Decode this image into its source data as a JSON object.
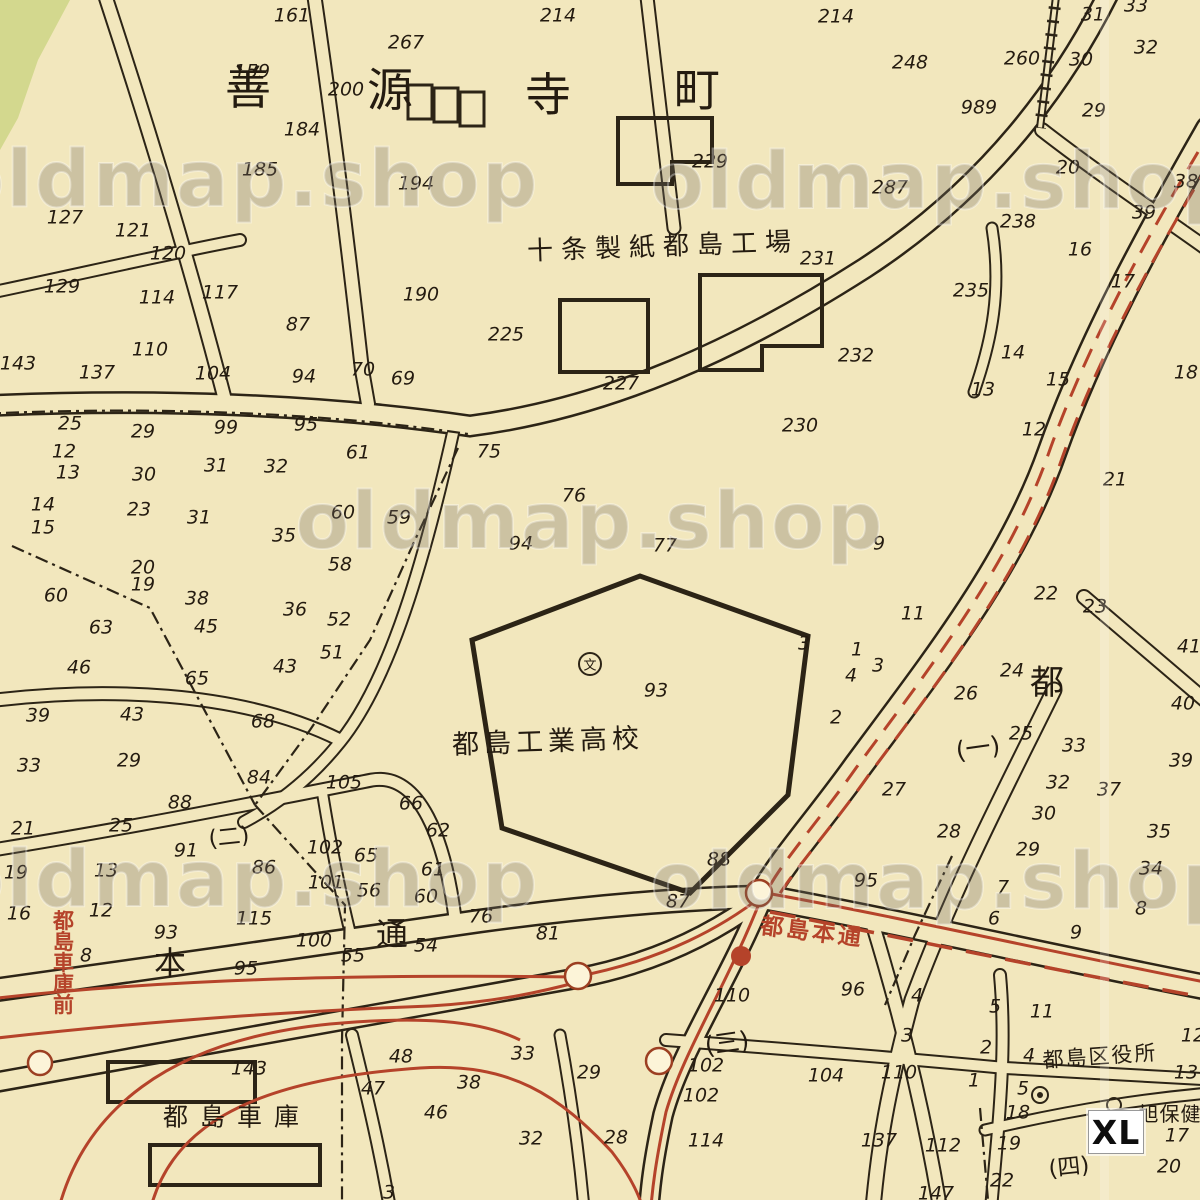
{
  "map": {
    "watermark_text": "oldmap.shop",
    "size_badge": "XL",
    "colors": {
      "paper": "#f2e7bd",
      "ink": "#2c2416",
      "tram_red": "#b5432a",
      "park_green": "#d3d88e"
    },
    "place_labels": [
      {
        "t": "善",
        "x": 248,
        "y": 88,
        "s": 46
      },
      {
        "t": "源",
        "x": 390,
        "y": 90,
        "s": 46
      },
      {
        "t": "寺",
        "x": 548,
        "y": 95,
        "s": 46
      },
      {
        "t": "町",
        "x": 697,
        "y": 90,
        "s": 46
      },
      {
        "t": "十条製紙都島工場",
        "x": 663,
        "y": 247,
        "s": 26,
        "ls": 8,
        "rot": -2
      },
      {
        "t": "都島工業高校",
        "x": 548,
        "y": 742,
        "s": 27,
        "ls": 5,
        "rot": -2
      },
      {
        "t": "文",
        "x": 590,
        "y": 666,
        "s": 13
      },
      {
        "t": "都",
        "x": 1047,
        "y": 683,
        "s": 34
      },
      {
        "t": "(一)",
        "x": 978,
        "y": 748,
        "s": 25,
        "rot": -8
      },
      {
        "t": "(二)",
        "x": 229,
        "y": 838,
        "s": 23,
        "rot": -6
      },
      {
        "t": "(三)",
        "x": 727,
        "y": 1043,
        "s": 25,
        "rot": -8
      },
      {
        "t": "(四)",
        "x": 1069,
        "y": 1168,
        "s": 23,
        "rot": -6
      },
      {
        "t": "都島区役所",
        "x": 1100,
        "y": 1057,
        "s": 21,
        "ls": 2,
        "rot": -4
      },
      {
        "t": "旭保健",
        "x": 1170,
        "y": 1114,
        "s": 20,
        "ls": 1
      },
      {
        "t": "都島車庫",
        "x": 237,
        "y": 1117,
        "s": 25,
        "ls": 12
      },
      {
        "t": "本",
        "x": 170,
        "y": 963,
        "s": 32
      },
      {
        "t": "通",
        "x": 392,
        "y": 934,
        "s": 32
      }
    ],
    "red_labels": [
      {
        "t": "都島本通",
        "x": 812,
        "y": 933,
        "s": 23,
        "ls": 3,
        "rot": 7
      },
      {
        "t": "都島車庫前",
        "x": 62,
        "y": 962,
        "s": 21,
        "vertical": true
      }
    ],
    "watermarks": [
      {
        "x": 245,
        "y": 180
      },
      {
        "x": 945,
        "y": 182
      },
      {
        "x": 590,
        "y": 522
      },
      {
        "x": 245,
        "y": 880
      },
      {
        "x": 945,
        "y": 882
      }
    ],
    "symbols": [
      {
        "name": "school-symbol",
        "x": 590,
        "y": 664
      },
      {
        "name": "ward-office-symbol",
        "x": 1040,
        "y": 1095
      },
      {
        "name": "health-center-symbol",
        "x": 1114,
        "y": 1105
      },
      {
        "name": "tram-stop",
        "x": 578,
        "y": 976
      },
      {
        "name": "tram-stop",
        "x": 759,
        "y": 893
      },
      {
        "name": "tram-stop",
        "x": 659,
        "y": 1061
      },
      {
        "name": "tram-stop",
        "x": 40,
        "y": 1063
      },
      {
        "name": "tram-stop-filled",
        "x": 741,
        "y": 956
      }
    ],
    "lot_numbers": [
      {
        "t": "161",
        "x": 292,
        "y": 16
      },
      {
        "t": "159",
        "x": 252,
        "y": 72
      },
      {
        "t": "184",
        "x": 302,
        "y": 130
      },
      {
        "t": "185",
        "x": 260,
        "y": 170
      },
      {
        "t": "127",
        "x": 65,
        "y": 218
      },
      {
        "t": "121",
        "x": 133,
        "y": 231
      },
      {
        "t": "120",
        "x": 168,
        "y": 254
      },
      {
        "t": "129",
        "x": 62,
        "y": 287
      },
      {
        "t": "114",
        "x": 157,
        "y": 298
      },
      {
        "t": "117",
        "x": 220,
        "y": 293
      },
      {
        "t": "87",
        "x": 298,
        "y": 325
      },
      {
        "t": "110",
        "x": 150,
        "y": 350
      },
      {
        "t": "143",
        "x": 18,
        "y": 364
      },
      {
        "t": "137",
        "x": 97,
        "y": 373
      },
      {
        "t": "104",
        "x": 213,
        "y": 374
      },
      {
        "t": "94",
        "x": 304,
        "y": 377
      },
      {
        "t": "70",
        "x": 363,
        "y": 370
      },
      {
        "t": "69",
        "x": 403,
        "y": 379
      },
      {
        "t": "214",
        "x": 558,
        "y": 16
      },
      {
        "t": "267",
        "x": 406,
        "y": 43
      },
      {
        "t": "200",
        "x": 346,
        "y": 90
      },
      {
        "t": "194",
        "x": 416,
        "y": 184
      },
      {
        "t": "229",
        "x": 710,
        "y": 162
      },
      {
        "t": "287",
        "x": 890,
        "y": 188
      },
      {
        "t": "231",
        "x": 818,
        "y": 259
      },
      {
        "t": "190",
        "x": 421,
        "y": 295
      },
      {
        "t": "225",
        "x": 506,
        "y": 335
      },
      {
        "t": "227",
        "x": 621,
        "y": 384
      },
      {
        "t": "232",
        "x": 856,
        "y": 356
      },
      {
        "t": "230",
        "x": 800,
        "y": 426
      },
      {
        "t": "214",
        "x": 836,
        "y": 17
      },
      {
        "t": "248",
        "x": 910,
        "y": 63
      },
      {
        "t": "260",
        "x": 1022,
        "y": 59
      },
      {
        "t": "31",
        "x": 1093,
        "y": 15
      },
      {
        "t": "30",
        "x": 1081,
        "y": 60
      },
      {
        "t": "32",
        "x": 1146,
        "y": 48
      },
      {
        "t": "33",
        "x": 1136,
        "y": 6
      },
      {
        "t": "989",
        "x": 979,
        "y": 108
      },
      {
        "t": "29",
        "x": 1094,
        "y": 111
      },
      {
        "t": "20",
        "x": 1068,
        "y": 168
      },
      {
        "t": "38",
        "x": 1186,
        "y": 182
      },
      {
        "t": "39",
        "x": 1144,
        "y": 213
      },
      {
        "t": "238",
        "x": 1018,
        "y": 222
      },
      {
        "t": "16",
        "x": 1080,
        "y": 250
      },
      {
        "t": "17",
        "x": 1123,
        "y": 282
      },
      {
        "t": "235",
        "x": 971,
        "y": 291
      },
      {
        "t": "14",
        "x": 1013,
        "y": 353
      },
      {
        "t": "15",
        "x": 1058,
        "y": 380
      },
      {
        "t": "13",
        "x": 983,
        "y": 390
      },
      {
        "t": "12",
        "x": 1034,
        "y": 430
      },
      {
        "t": "18",
        "x": 1186,
        "y": 373
      },
      {
        "t": "21",
        "x": 1115,
        "y": 480
      },
      {
        "t": "25",
        "x": 70,
        "y": 424
      },
      {
        "t": "29",
        "x": 143,
        "y": 432
      },
      {
        "t": "12",
        "x": 64,
        "y": 452
      },
      {
        "t": "13",
        "x": 68,
        "y": 473
      },
      {
        "t": "30",
        "x": 144,
        "y": 475
      },
      {
        "t": "23",
        "x": 139,
        "y": 510
      },
      {
        "t": "14",
        "x": 43,
        "y": 505
      },
      {
        "t": "15",
        "x": 43,
        "y": 528
      },
      {
        "t": "99",
        "x": 226,
        "y": 428
      },
      {
        "t": "95",
        "x": 306,
        "y": 425
      },
      {
        "t": "31",
        "x": 216,
        "y": 466
      },
      {
        "t": "32",
        "x": 276,
        "y": 467
      },
      {
        "t": "31",
        "x": 199,
        "y": 518
      },
      {
        "t": "35",
        "x": 284,
        "y": 536
      },
      {
        "t": "20",
        "x": 143,
        "y": 568
      },
      {
        "t": "19",
        "x": 143,
        "y": 585
      },
      {
        "t": "60",
        "x": 56,
        "y": 596
      },
      {
        "t": "38",
        "x": 197,
        "y": 599
      },
      {
        "t": "36",
        "x": 295,
        "y": 610
      },
      {
        "t": "63",
        "x": 101,
        "y": 628
      },
      {
        "t": "45",
        "x": 206,
        "y": 627
      },
      {
        "t": "43",
        "x": 285,
        "y": 667
      },
      {
        "t": "65",
        "x": 197,
        "y": 679
      },
      {
        "t": "46",
        "x": 79,
        "y": 668
      },
      {
        "t": "39",
        "x": 38,
        "y": 716
      },
      {
        "t": "43",
        "x": 132,
        "y": 715
      },
      {
        "t": "61",
        "x": 358,
        "y": 453
      },
      {
        "t": "75",
        "x": 489,
        "y": 452
      },
      {
        "t": "60",
        "x": 343,
        "y": 513
      },
      {
        "t": "59",
        "x": 399,
        "y": 518
      },
      {
        "t": "58",
        "x": 340,
        "y": 565
      },
      {
        "t": "52",
        "x": 339,
        "y": 620
      },
      {
        "t": "51",
        "x": 332,
        "y": 653
      },
      {
        "t": "94",
        "x": 521,
        "y": 544
      },
      {
        "t": "76",
        "x": 574,
        "y": 496
      },
      {
        "t": "77",
        "x": 665,
        "y": 546
      },
      {
        "t": "9",
        "x": 879,
        "y": 544
      },
      {
        "t": "11",
        "x": 913,
        "y": 614
      },
      {
        "t": "3",
        "x": 804,
        "y": 644
      },
      {
        "t": "1",
        "x": 857,
        "y": 650
      },
      {
        "t": "3",
        "x": 878,
        "y": 666
      },
      {
        "t": "4",
        "x": 851,
        "y": 676
      },
      {
        "t": "2",
        "x": 836,
        "y": 718
      },
      {
        "t": "93",
        "x": 656,
        "y": 691
      },
      {
        "t": "22",
        "x": 1046,
        "y": 594
      },
      {
        "t": "23",
        "x": 1095,
        "y": 607
      },
      {
        "t": "24",
        "x": 1012,
        "y": 671
      },
      {
        "t": "26",
        "x": 966,
        "y": 694
      },
      {
        "t": "27",
        "x": 894,
        "y": 790
      },
      {
        "t": "25",
        "x": 1021,
        "y": 734
      },
      {
        "t": "33",
        "x": 1074,
        "y": 746
      },
      {
        "t": "40",
        "x": 1183,
        "y": 704
      },
      {
        "t": "41",
        "x": 1189,
        "y": 647
      },
      {
        "t": "39",
        "x": 1181,
        "y": 761
      },
      {
        "t": "32",
        "x": 1058,
        "y": 783
      },
      {
        "t": "37",
        "x": 1109,
        "y": 790
      },
      {
        "t": "30",
        "x": 1044,
        "y": 814
      },
      {
        "t": "35",
        "x": 1159,
        "y": 832
      },
      {
        "t": "28",
        "x": 949,
        "y": 832
      },
      {
        "t": "29",
        "x": 1028,
        "y": 850
      },
      {
        "t": "34",
        "x": 1151,
        "y": 869
      },
      {
        "t": "68",
        "x": 263,
        "y": 722
      },
      {
        "t": "84",
        "x": 259,
        "y": 778
      },
      {
        "t": "88",
        "x": 180,
        "y": 803
      },
      {
        "t": "33",
        "x": 29,
        "y": 766
      },
      {
        "t": "29",
        "x": 129,
        "y": 761
      },
      {
        "t": "21",
        "x": 23,
        "y": 829
      },
      {
        "t": "25",
        "x": 121,
        "y": 826
      },
      {
        "t": "91",
        "x": 186,
        "y": 851
      },
      {
        "t": "86",
        "x": 264,
        "y": 868
      },
      {
        "t": "19",
        "x": 16,
        "y": 873
      },
      {
        "t": "13",
        "x": 106,
        "y": 871
      },
      {
        "t": "16",
        "x": 19,
        "y": 914
      },
      {
        "t": "12",
        "x": 101,
        "y": 911
      },
      {
        "t": "8",
        "x": 86,
        "y": 956
      },
      {
        "t": "93",
        "x": 166,
        "y": 933
      },
      {
        "t": "115",
        "x": 254,
        "y": 919
      },
      {
        "t": "100",
        "x": 314,
        "y": 941
      },
      {
        "t": "95",
        "x": 246,
        "y": 969
      },
      {
        "t": "55",
        "x": 353,
        "y": 956
      },
      {
        "t": "54",
        "x": 426,
        "y": 946
      },
      {
        "t": "105",
        "x": 344,
        "y": 783
      },
      {
        "t": "66",
        "x": 411,
        "y": 804
      },
      {
        "t": "62",
        "x": 438,
        "y": 831
      },
      {
        "t": "102",
        "x": 325,
        "y": 848
      },
      {
        "t": "65",
        "x": 366,
        "y": 856
      },
      {
        "t": "61",
        "x": 433,
        "y": 870
      },
      {
        "t": "101",
        "x": 326,
        "y": 883
      },
      {
        "t": "56",
        "x": 369,
        "y": 891
      },
      {
        "t": "60",
        "x": 426,
        "y": 897
      },
      {
        "t": "76",
        "x": 481,
        "y": 917
      },
      {
        "t": "81",
        "x": 548,
        "y": 934
      },
      {
        "t": "87",
        "x": 678,
        "y": 902
      },
      {
        "t": "88",
        "x": 719,
        "y": 860
      },
      {
        "t": "95",
        "x": 866,
        "y": 881
      },
      {
        "t": "7",
        "x": 1003,
        "y": 888
      },
      {
        "t": "6",
        "x": 994,
        "y": 919
      },
      {
        "t": "9",
        "x": 1076,
        "y": 933
      },
      {
        "t": "8",
        "x": 1141,
        "y": 909
      },
      {
        "t": "96",
        "x": 853,
        "y": 990
      },
      {
        "t": "4",
        "x": 917,
        "y": 996
      },
      {
        "t": "5",
        "x": 995,
        "y": 1007
      },
      {
        "t": "11",
        "x": 1042,
        "y": 1012
      },
      {
        "t": "3",
        "x": 907,
        "y": 1036
      },
      {
        "t": "2",
        "x": 986,
        "y": 1048
      },
      {
        "t": "1",
        "x": 974,
        "y": 1081
      },
      {
        "t": "110",
        "x": 732,
        "y": 996
      },
      {
        "t": "102",
        "x": 706,
        "y": 1066
      },
      {
        "t": "102",
        "x": 701,
        "y": 1096
      },
      {
        "t": "114",
        "x": 706,
        "y": 1141
      },
      {
        "t": "104",
        "x": 826,
        "y": 1076
      },
      {
        "t": "110",
        "x": 899,
        "y": 1073
      },
      {
        "t": "137",
        "x": 879,
        "y": 1141
      },
      {
        "t": "112",
        "x": 943,
        "y": 1146
      },
      {
        "t": "147",
        "x": 936,
        "y": 1194
      },
      {
        "t": "12",
        "x": 1193,
        "y": 1036
      },
      {
        "t": "13",
        "x": 1186,
        "y": 1073
      },
      {
        "t": "4",
        "x": 1029,
        "y": 1056
      },
      {
        "t": "5",
        "x": 1023,
        "y": 1089
      },
      {
        "t": "18",
        "x": 1018,
        "y": 1113
      },
      {
        "t": "19",
        "x": 1009,
        "y": 1144
      },
      {
        "t": "22",
        "x": 1002,
        "y": 1181
      },
      {
        "t": "20",
        "x": 1169,
        "y": 1167
      },
      {
        "t": "17",
        "x": 1177,
        "y": 1136
      },
      {
        "t": "143",
        "x": 249,
        "y": 1069
      },
      {
        "t": "48",
        "x": 401,
        "y": 1057
      },
      {
        "t": "47",
        "x": 373,
        "y": 1089
      },
      {
        "t": "46",
        "x": 436,
        "y": 1113
      },
      {
        "t": "38",
        "x": 469,
        "y": 1083
      },
      {
        "t": "33",
        "x": 523,
        "y": 1054
      },
      {
        "t": "32",
        "x": 531,
        "y": 1139
      },
      {
        "t": "29",
        "x": 589,
        "y": 1073
      },
      {
        "t": "28",
        "x": 616,
        "y": 1138
      },
      {
        "t": "3",
        "x": 389,
        "y": 1193
      }
    ]
  }
}
